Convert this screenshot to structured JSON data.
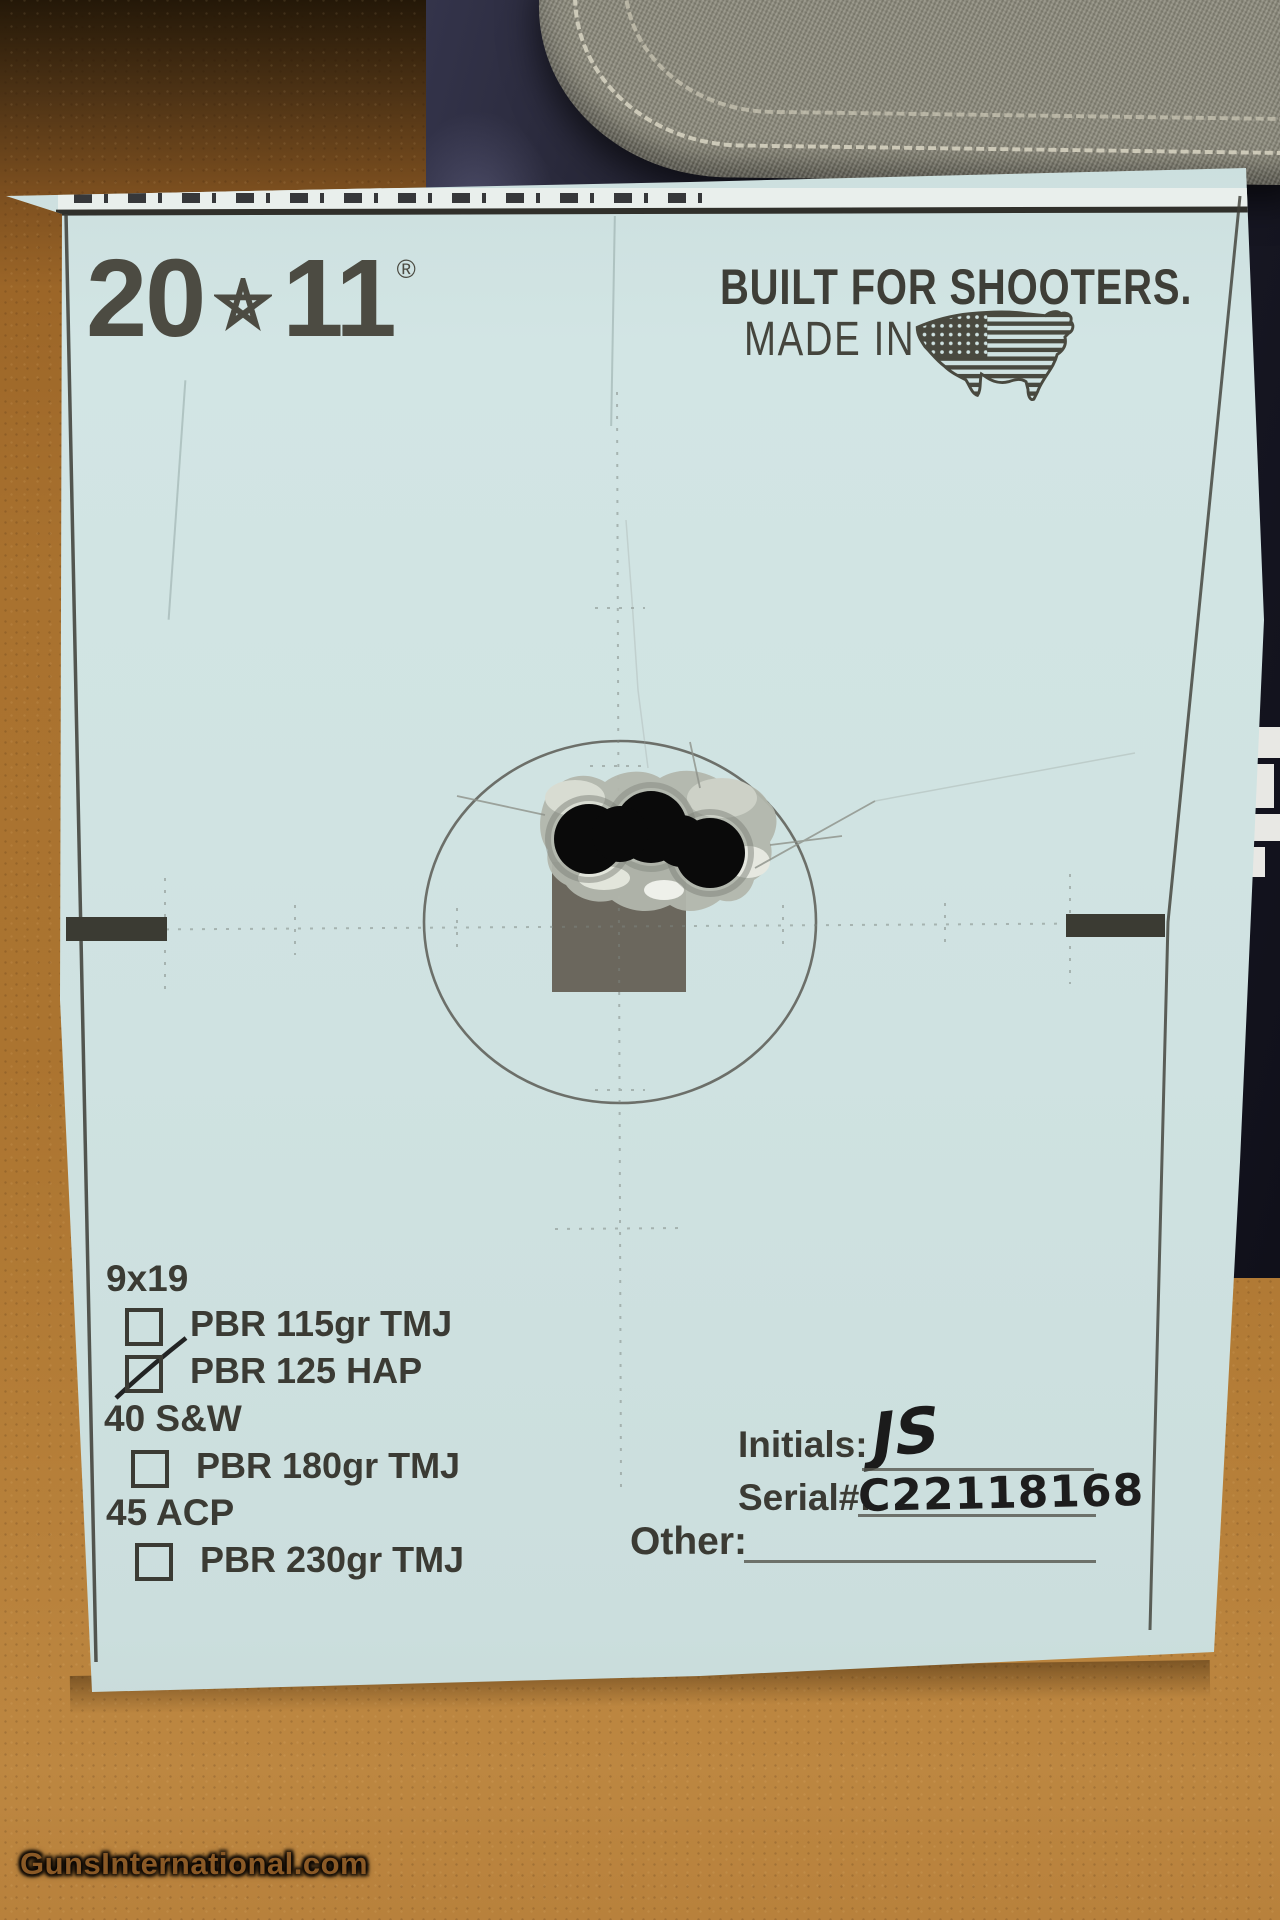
{
  "target": {
    "brand": {
      "left": "20",
      "right": "11",
      "registered": "®"
    },
    "tagline": "BUILT FOR SHOOTERS.",
    "made_in_label": "MADE IN",
    "ammo_sections": [
      {
        "caliber": "9x19",
        "options": [
          {
            "label": "PBR 115gr TMJ",
            "checked": false
          },
          {
            "label": "PBR 125 HAP",
            "checked": true
          }
        ]
      },
      {
        "caliber": "40 S&W",
        "options": [
          {
            "label": "PBR 180gr TMJ",
            "checked": false
          }
        ]
      },
      {
        "caliber": "45 ACP",
        "options": [
          {
            "label": "PBR 230gr TMJ",
            "checked": false
          }
        ]
      }
    ],
    "fields": {
      "initials_label": "Initials:",
      "initials_value": "JS",
      "serial_label": "Serial#:",
      "serial_value": "C22118168",
      "other_label": "Other:",
      "other_value": ""
    },
    "shot_group": {
      "holes": 3,
      "location": "just above center aiming square, inside circle"
    },
    "colors": {
      "paper": "#cfe2e1",
      "print_dark": "#3b3b34",
      "aim_square": "#6b675d",
      "cardboard": "#a9722f",
      "pistol_box_navy": "#1e1e2e",
      "pouch_fabric": "#8e8c7d"
    }
  },
  "watermark": {
    "text": "GunsInternational.com"
  }
}
